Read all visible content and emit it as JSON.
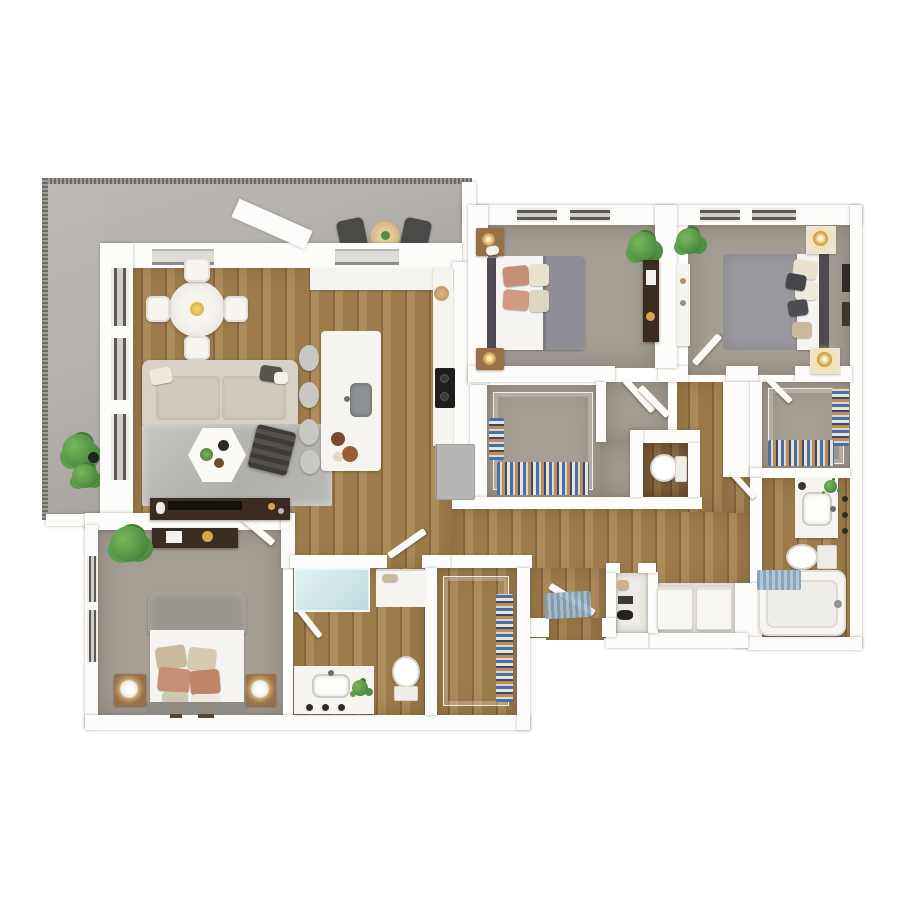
{
  "scene": {
    "type": "3d-rendered-apartment-floor-plan",
    "visible_text": "none",
    "bedrooms": 3,
    "bathrooms": 2.5,
    "orientation": "top-down isometric render on white background"
  },
  "palette": {
    "wall": "#fcfcfb",
    "wood": "#9d7b4b",
    "wood_dark": "#876741",
    "wood_light": "#ae8d5c",
    "wood_wc": "#7a5a38",
    "carpet": "#a59e94",
    "balcony": "#b4b1ae",
    "railing": "#6e6a66",
    "sofa": "#d7d1c7",
    "fabric_gray": "#8f8e96",
    "duvet_gray": "#99989e",
    "headboard": "#524c55",
    "pillow_peach": "#c68f75",
    "pillow_cream": "#e8e1d0",
    "pillow_tan": "#c9ba9b",
    "nightstand": "#96704a",
    "gold": "#d9a84e",
    "dark_wood": "#3a2c21",
    "plant": "#4f8f42",
    "plant_light": "#7ab65c",
    "shower_glass": "#cde5e7",
    "mat_blue": "#7e9db6",
    "mat_blue_light": "#aac2d4",
    "clothes_blue": "#4a6fa5",
    "clothes_tan": "#b98d5f",
    "clothes_dark": "#3b4a66",
    "clothes_light": "#ddd8cc",
    "cooktop": "#1f1e1c",
    "fridge": "#b7b5b3"
  },
  "rooms": [
    {
      "id": "balcony",
      "name": "Balcony",
      "floor": "concrete",
      "furniture": [
        "bistro-table",
        "patio-chair",
        "patio-chair",
        "potted-plant"
      ]
    },
    {
      "id": "living-room",
      "name": "Living Room",
      "floor": "hardwood",
      "furniture": [
        "sofa",
        "area-rug",
        "hexagon-coffee-table",
        "striped-ottoman",
        "media-console",
        "tv"
      ]
    },
    {
      "id": "dining-area",
      "name": "Dining Area",
      "floor": "hardwood",
      "furniture": [
        "round-dining-table",
        "dining-chair-x4",
        "centerpiece-bowl"
      ]
    },
    {
      "id": "kitchen",
      "name": "Kitchen",
      "floor": "hardwood",
      "furniture": [
        "island-with-sink",
        "bar-stool-x4",
        "counter-run",
        "cooktop",
        "refrigerator",
        "fruit-bowl"
      ]
    },
    {
      "id": "bedroom-2",
      "name": "Bedroom 2",
      "floor": "carpet",
      "furniture": [
        "queen-bed",
        "nightstand-x2",
        "table-lamp-x2",
        "dresser",
        "plant"
      ]
    },
    {
      "id": "bedroom-3",
      "name": "Bedroom 3",
      "floor": "carpet",
      "furniture": [
        "queen-bed",
        "nightstand-x2",
        "table-lamp-x2",
        "desk",
        "plant",
        "wall-art"
      ]
    },
    {
      "id": "master-bedroom",
      "name": "Master Bedroom",
      "floor": "carpet",
      "furniture": [
        "king-bed",
        "nightstand-x2",
        "table-lamp-x2",
        "dresser",
        "plant"
      ]
    },
    {
      "id": "master-bathroom",
      "name": "Master Bathroom",
      "floor": "hardwood",
      "furniture": [
        "glass-shower",
        "linen-niche",
        "double-vanity",
        "toilet",
        "plant"
      ]
    },
    {
      "id": "master-closet",
      "name": "Master Walk-in Closet",
      "floor": "hardwood",
      "furniture": [
        "wire-shelving",
        "hanging-clothes"
      ]
    },
    {
      "id": "walk-in-closet-1",
      "name": "Walk-in Closet (Bedroom 2)",
      "floor": "carpet",
      "furniture": [
        "wire-shelving",
        "hanging-clothes",
        "folded-clothes"
      ]
    },
    {
      "id": "walk-in-closet-2",
      "name": "Walk-in Closet (Bedroom 3)",
      "floor": "carpet",
      "furniture": [
        "wire-shelving",
        "hanging-clothes"
      ]
    },
    {
      "id": "bathroom-2",
      "name": "Bathroom 2",
      "floor": "hardwood",
      "furniture": [
        "vanity-sink",
        "toilet",
        "bathtub",
        "bath-mat",
        "sconces"
      ]
    },
    {
      "id": "powder-room",
      "name": "Powder Room",
      "floor": "dark-hardwood",
      "furniture": [
        "toilet"
      ]
    },
    {
      "id": "vestibule",
      "name": "Bedroom Vestibule",
      "floor": "carpet",
      "furniture": [
        "door"
      ]
    },
    {
      "id": "hallway",
      "name": "Hallway",
      "floor": "hardwood",
      "furniture": []
    },
    {
      "id": "entry",
      "name": "Entry",
      "floor": "hardwood",
      "furniture": [
        "entry-door",
        "doormat"
      ]
    },
    {
      "id": "linen-closet",
      "name": "Linen Closet",
      "floor": "tile",
      "furniture": [
        "shelved-items"
      ]
    },
    {
      "id": "laundry-closet",
      "name": "Laundry Closet",
      "floor": "tile",
      "furniture": [
        "washer",
        "dryer"
      ]
    }
  ]
}
